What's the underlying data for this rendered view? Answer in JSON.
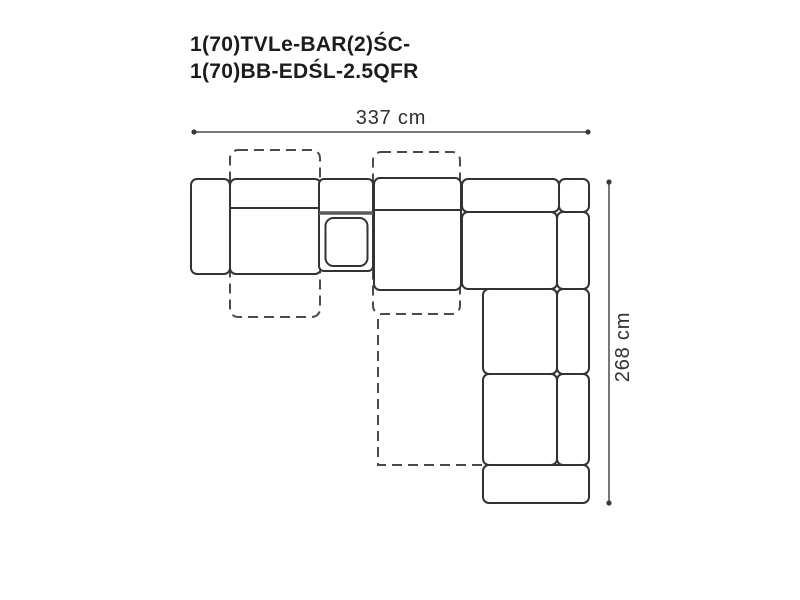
{
  "title": {
    "line1": "1(70)TVLe-BAR(2)ŚC-",
    "line2": "1(70)BB-EDŚL-2.5QFR"
  },
  "dimensions": {
    "width": {
      "label": "337 cm"
    },
    "height": {
      "label": "268 cm"
    }
  },
  "colors": {
    "background": "#ffffff",
    "outline": "#333333",
    "dashed_outline": "#4a4a4a",
    "dimension_line": "#4a4a4a",
    "dimension_dot": "#3a3a3a",
    "console_divider": "#5a5a5a",
    "title_text": "#1c1c1c",
    "dimension_text": "#2f2f2f"
  }
}
